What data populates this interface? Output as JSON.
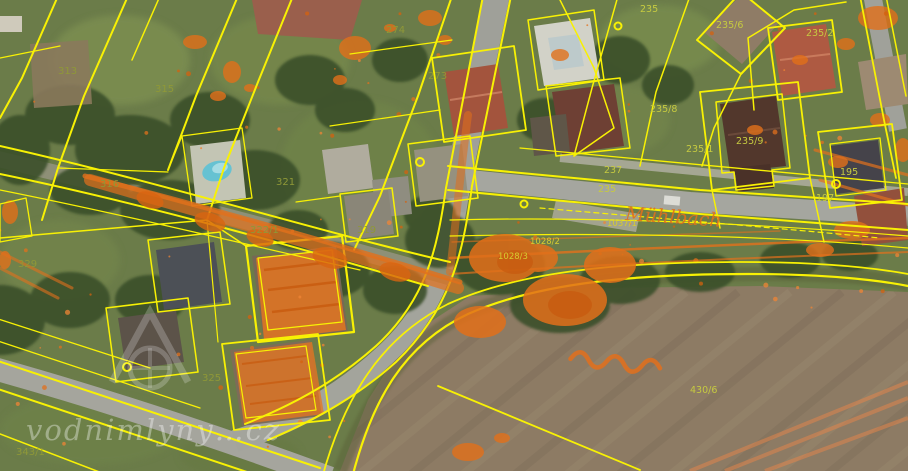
{
  "map": {
    "watermark": {
      "text": "vodnimlyny…cz"
    },
    "stream_label": "Mühlbach",
    "parcel_labels": [
      {
        "text": "313"
      },
      {
        "text": "315"
      },
      {
        "text": "274"
      },
      {
        "text": "273"
      },
      {
        "text": "235"
      },
      {
        "text": "235/6"
      },
      {
        "text": "235/2"
      },
      {
        "text": "235/8"
      },
      {
        "text": "235/1"
      },
      {
        "text": "235/9"
      },
      {
        "text": "237"
      },
      {
        "text": "235"
      },
      {
        "text": "195"
      },
      {
        "text": "197"
      },
      {
        "text": "321"
      },
      {
        "text": "319"
      },
      {
        "text": "322/1"
      },
      {
        "text": "316"
      },
      {
        "text": "329"
      },
      {
        "text": "325"
      },
      {
        "text": "343/1"
      },
      {
        "text": "430/6"
      },
      {
        "text": "1037/1"
      },
      {
        "text": "1028/2"
      },
      {
        "text": "1028/3"
      }
    ],
    "colors": {
      "cadastral_line": "#f8f104",
      "historic_overlay": "#e2701c",
      "parcel_label": "#c6ca40",
      "watermark": "#ffffff"
    }
  }
}
